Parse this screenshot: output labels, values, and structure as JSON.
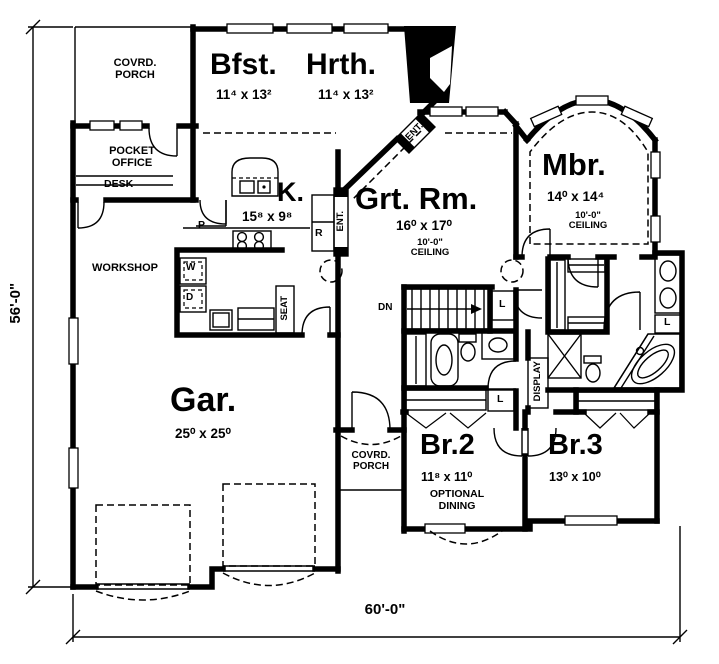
{
  "plan": {
    "dimensions": {
      "left": "56'-0\"",
      "bottom": "60'-0\""
    },
    "rooms": {
      "covered_porch_top": {
        "label": "COVRD. PORCH"
      },
      "breakfast": {
        "name": "Bfst.",
        "dims": "11⁴ x 13²"
      },
      "hearth": {
        "name": "Hrth.",
        "dims": "11⁴ x 13²"
      },
      "pocket_office": {
        "label": "POCKET OFFICE"
      },
      "desk": {
        "label": "DESK"
      },
      "kitchen": {
        "name": "K.",
        "dims": "15⁸ x 9⁸"
      },
      "great_room": {
        "name": "Grt. Rm.",
        "dims": "16⁰ x 17⁰",
        "ceiling": "10'-0\" CEILING"
      },
      "master_bedroom": {
        "name": "Mbr.",
        "dims": "14⁰ x 14⁴",
        "ceiling": "10'-0\" CEILING"
      },
      "workshop": {
        "label": "WORKSHOP"
      },
      "garage": {
        "name": "Gar.",
        "dims": "25⁰ x 25⁰"
      },
      "covered_porch_bottom": {
        "label": "COVRD. PORCH"
      },
      "bedroom2": {
        "name": "Br.2",
        "dims": "11⁸ x 11⁰",
        "note": "OPTIONAL DINING"
      },
      "bedroom3": {
        "name": "Br.3",
        "dims": "13⁰ x 10⁰"
      }
    },
    "annotations": {
      "entry_upper": "ENT.",
      "entry_lower": "ENT.",
      "stairs_down": "DN",
      "seat": "SEAT",
      "display": "DISPLAY",
      "washer": "W",
      "dryer": "D",
      "pantry": "P",
      "range": "R",
      "linen_stairs": "L",
      "linen_hall": "L",
      "linen_master": "L"
    }
  }
}
